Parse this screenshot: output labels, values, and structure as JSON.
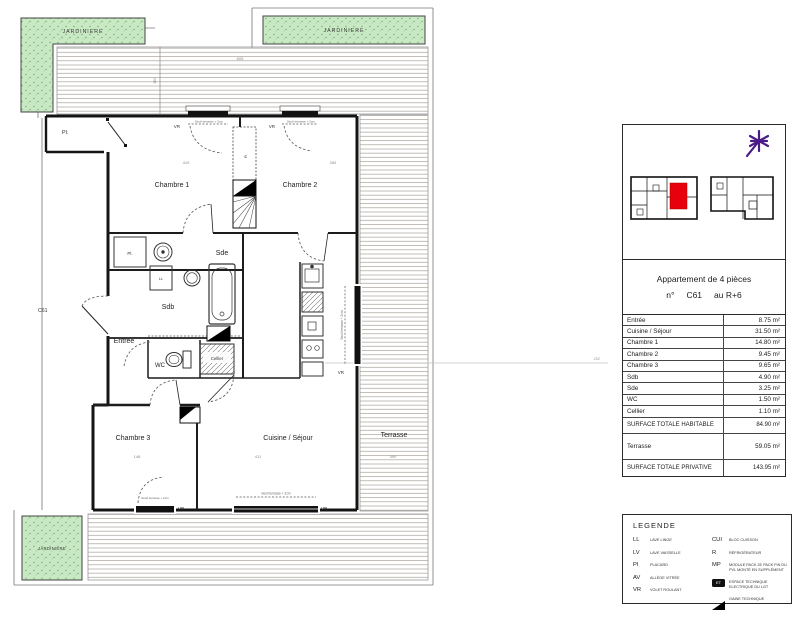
{
  "plan": {
    "jardiniere_label": "JARDINIERE",
    "rooms": {
      "chambre1": "Chambre 1",
      "chambre2": "Chambre 2",
      "chambre3": "Chambre 3",
      "sde": "Sde",
      "sdb": "Sdb",
      "entree": "Entrée",
      "wc": "WC",
      "cellier": "Cellier",
      "cuisine": "Cuisine / Séjour",
      "terrasse": "Terrasse"
    },
    "labels": {
      "pl": "Pl.",
      "unit_door": "C61",
      "vr": "VR",
      "seuil_note": "Seuil terrasse + 2cm",
      "ll": "LL"
    },
    "dims": {
      "terrace_top": "605",
      "deck_depth": "160",
      "chambre1": "419",
      "chambre2": "284",
      "chambre3": "148",
      "cuisine": "411",
      "terrasse": "390",
      "leader": "252"
    }
  },
  "panel": {
    "title": "Appartement de 4 pièces",
    "numero_prefix": "n°",
    "unit_number": "C61",
    "floor": "au R+6",
    "rows": [
      {
        "label": "Entrée",
        "value": "8.75 m²"
      },
      {
        "label": "Cuisine / Séjour",
        "value": "31.50 m²"
      },
      {
        "label": "Chambre 1",
        "value": "14.80 m²"
      },
      {
        "label": "Chambre 2",
        "value": "9.45 m²"
      },
      {
        "label": "Chambre 3",
        "value": "9.65 m²"
      },
      {
        "label": "Sdb",
        "value": "4.90 m²"
      },
      {
        "label": "Sde",
        "value": "3.25 m²"
      },
      {
        "label": "WC",
        "value": "1.50 m²"
      },
      {
        "label": "Cellier",
        "value": "1.10 m²"
      }
    ],
    "surface_habitable": {
      "label": "SURFACE TOTALE HABITABLE",
      "value": "84.90 m²"
    },
    "terrasse_row": {
      "label": "Terrasse",
      "value": "59.05 m²"
    },
    "surface_privative": {
      "label": "SURFACE TOTALE PRIVATIVE",
      "value": "143.95 m²"
    }
  },
  "legend": {
    "title": "LEGENDE",
    "left": [
      {
        "abbr": "LL",
        "label": "LAVE LINGE"
      },
      {
        "abbr": "LV",
        "label": "LAVE VAISSELLE"
      },
      {
        "abbr": "PI",
        "label": "PLACARD"
      },
      {
        "abbr": "AV",
        "label": "ALLÈGE VITRÉE"
      },
      {
        "abbr": "VR",
        "label": "VOLET ROULANT"
      }
    ],
    "right": [
      {
        "abbr": "CUI",
        "label": "BLOC CUISSON"
      },
      {
        "abbr": "R",
        "label": "RÉFRIGÉRATEUR"
      },
      {
        "abbr": "MP",
        "label": "MODULE PACK 2E PACK FIN DU PVL MONTÉ EN SUPPLÉMENT"
      },
      {
        "abbr": "ET",
        "label": "ESPACE TECHNIQUE ELECTRIQUE DU LGT"
      },
      {
        "abbr": "",
        "label": "GAINE TECHNIQUE"
      }
    ]
  }
}
